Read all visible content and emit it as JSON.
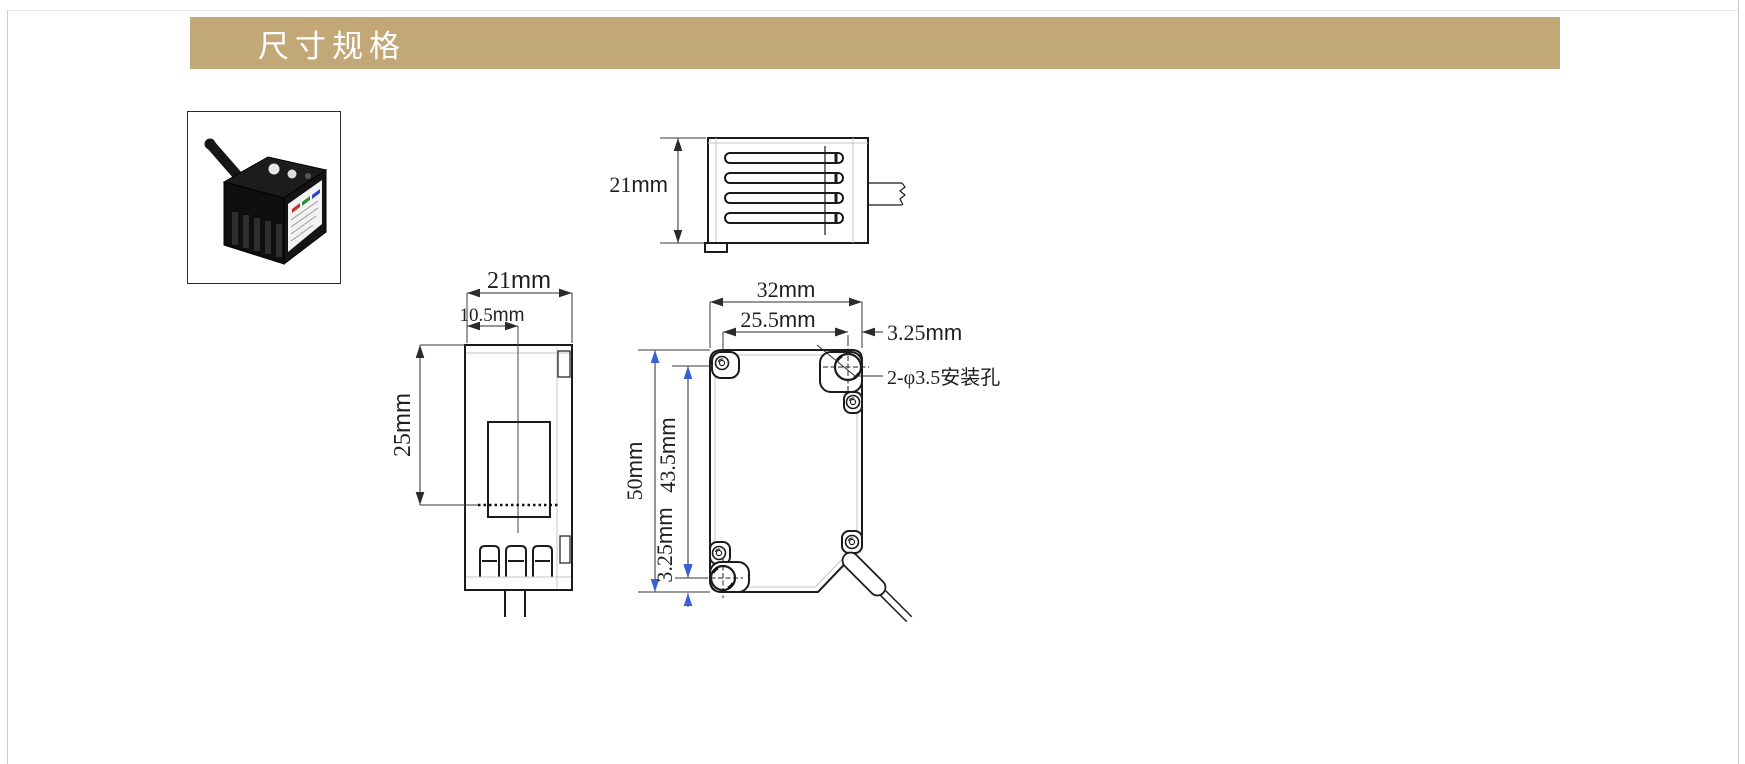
{
  "page": {
    "section_title": "尺寸规格"
  },
  "colors": {
    "header_bg": "#c3a877",
    "header_text": "#ffffff",
    "dim_arrow_blue": "#3a5fd0",
    "drawing_line": "#1b1b1b",
    "page_edge": "#c9ced3",
    "label_stripe_red": "#c23228",
    "label_stripe_green": "#2d8a35",
    "label_stripe_blue": "#2b46c8"
  },
  "top_view": {
    "height": {
      "v": "21",
      "u": "mm"
    }
  },
  "front_view": {
    "width": {
      "v": "21",
      "u": "mm"
    },
    "half_width": {
      "v": "10.5",
      "u": "mm"
    },
    "beam_center": {
      "v": "25",
      "u": "mm"
    }
  },
  "side_view": {
    "width": {
      "v": "32",
      "u": "mm"
    },
    "hole_span_h": {
      "v": "25.5",
      "u": "mm"
    },
    "hole_offset_top": {
      "v": "3.25",
      "u": "mm"
    },
    "height": {
      "v": "50",
      "u": "mm"
    },
    "hole_span_v": {
      "v": "43.5",
      "u": "mm"
    },
    "hole_offset_bottom": {
      "v": "3.25",
      "u": "mm"
    },
    "mounting_hole_note": "2-φ3.5安装孔"
  }
}
